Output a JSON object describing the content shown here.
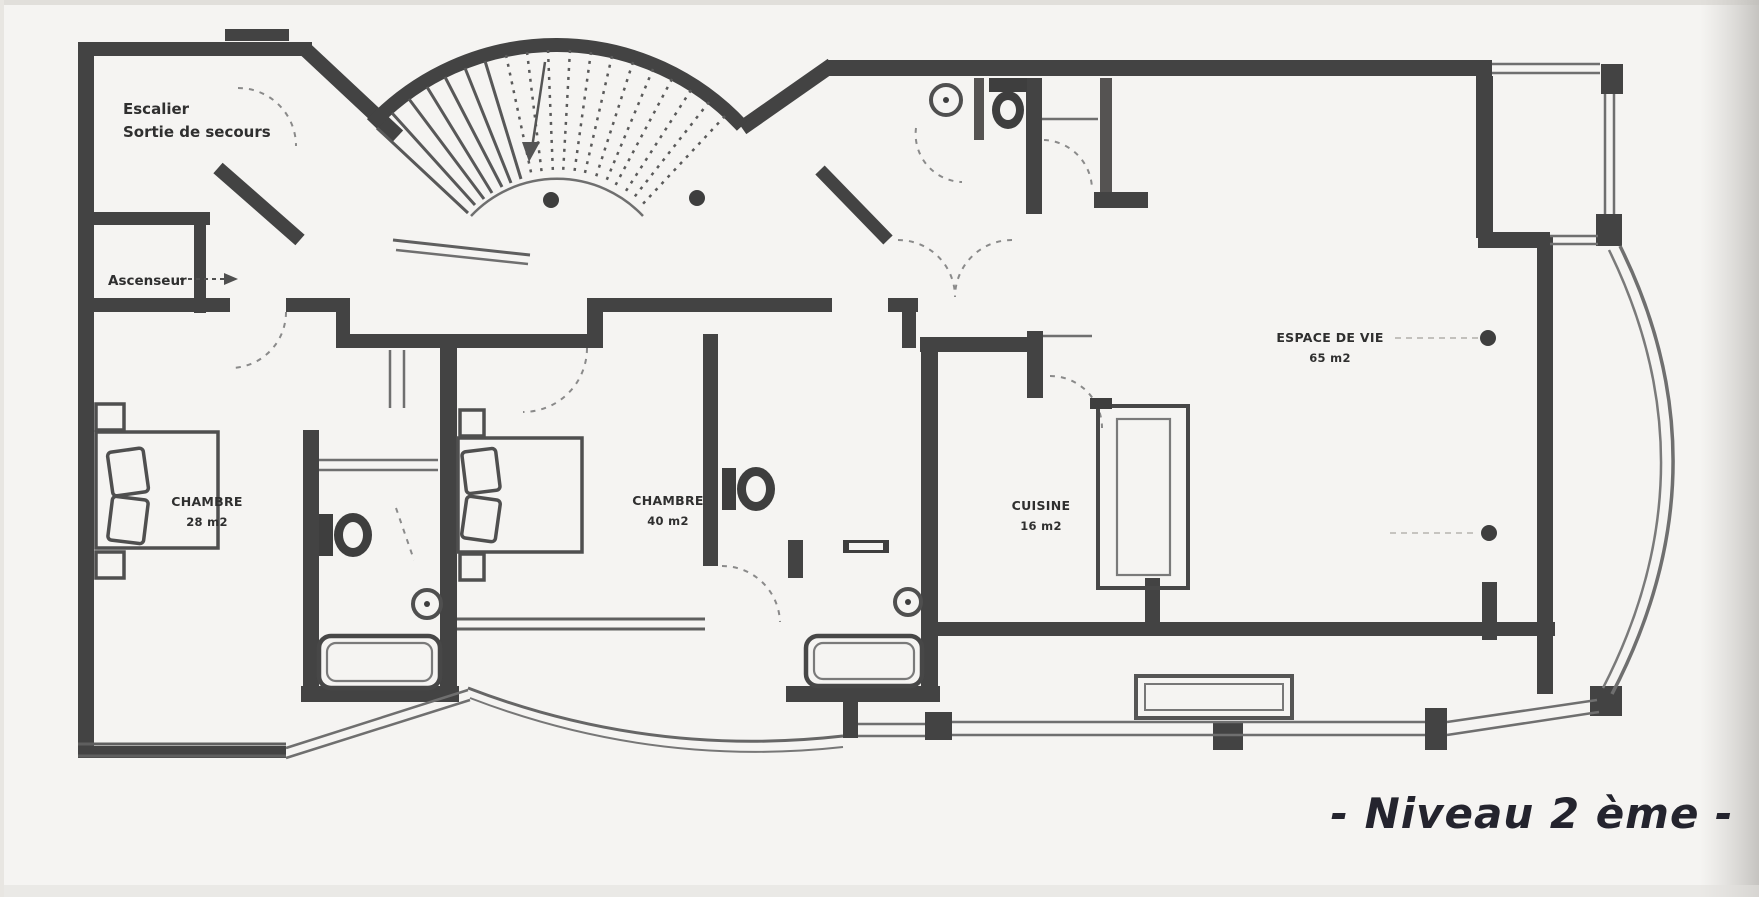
{
  "colors": {
    "paper": "#f5f4f2",
    "wall_ink": "#434343",
    "thin_line": "#6f6f6f",
    "caption_ink": "#24242e"
  },
  "plan": {
    "stairwell": {
      "line1": "Escalier",
      "line2": "Sortie de secours"
    },
    "elevator": {
      "label": "Ascenseur"
    },
    "rooms": {
      "bedroom1": {
        "name": "CHAMBRE",
        "area": "28 m2"
      },
      "bedroom2": {
        "name": "CHAMBRE",
        "area": "40 m2"
      },
      "kitchen": {
        "name": "CUISINE",
        "area": "16 m2"
      },
      "living": {
        "name": "ESPACE DE VIE",
        "area": "65 m2"
      }
    },
    "caption": "- Niveau 2 ème -"
  }
}
